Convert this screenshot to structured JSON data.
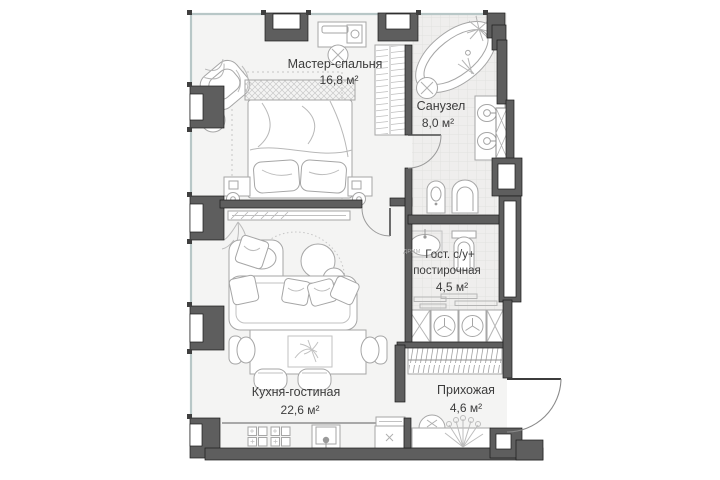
{
  "plan_type": "apartment-floor-plan",
  "rooms": {
    "master_bedroom": {
      "label": "Мастер-спальня",
      "area": "16,8 м²"
    },
    "bathroom": {
      "label": "Санузел",
      "area": "8,0 м²"
    },
    "guest_wc": {
      "label_line1": "Гост. с/у+",
      "label_line2": "постирочная",
      "area": "4,5 м²"
    },
    "kitchen_living": {
      "label": "Кухня-гостиная",
      "area": "22,6 м²"
    },
    "hallway": {
      "label": "Прихожая",
      "area": "4,6 м²"
    }
  },
  "annotations": {
    "sink_label": "ДРИМ"
  },
  "colors": {
    "wall": "#5e5e5e",
    "wall_outline": "#1a1a1a",
    "floor": "#f4f4f3",
    "tile": "#efeeed",
    "furniture_stroke": "#a6a6a6",
    "window": "#b8c7c7",
    "text": "#3c3c3c"
  }
}
